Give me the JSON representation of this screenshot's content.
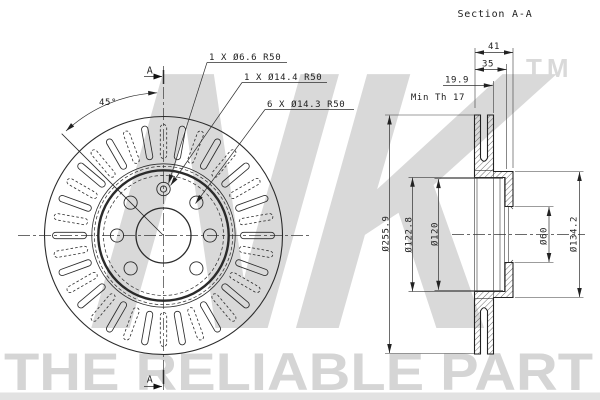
{
  "title": "Section A-A",
  "watermark": {
    "logo": "NK",
    "tm": "TM",
    "slogan": "THE RELIABLE PART",
    "logo_color": "#d9d9d9",
    "slogan_color": "#d5d5d5",
    "band_color": "#e2e2e2"
  },
  "front_view": {
    "angle_label": "45°",
    "section_marker_top": "A",
    "section_marker_bottom": "A",
    "callouts": [
      "1 X Ø6.6 R50",
      "1 X Ø14.4 R50",
      "6 X Ø14.3 R50"
    ],
    "vent_slots": {
      "count": 36,
      "step_deg": 10
    },
    "bolt_holes": {
      "count": 6,
      "angles_deg": [
        0,
        45,
        135,
        180,
        225,
        315
      ]
    }
  },
  "section_view": {
    "width_total": "41",
    "width_inner": "35",
    "disc_thickness": "19.9",
    "min_thickness_note": "Min Th 17",
    "outer_diameter": "Ø255.9",
    "hat_diameter_outer": "Ø122.8",
    "hat_diameter_inner": "Ø120",
    "bore_diameter": "Ø60",
    "hub_diameter": "Ø134.2"
  },
  "colors": {
    "line": "#2b2b2b",
    "background": "#ffffff"
  }
}
